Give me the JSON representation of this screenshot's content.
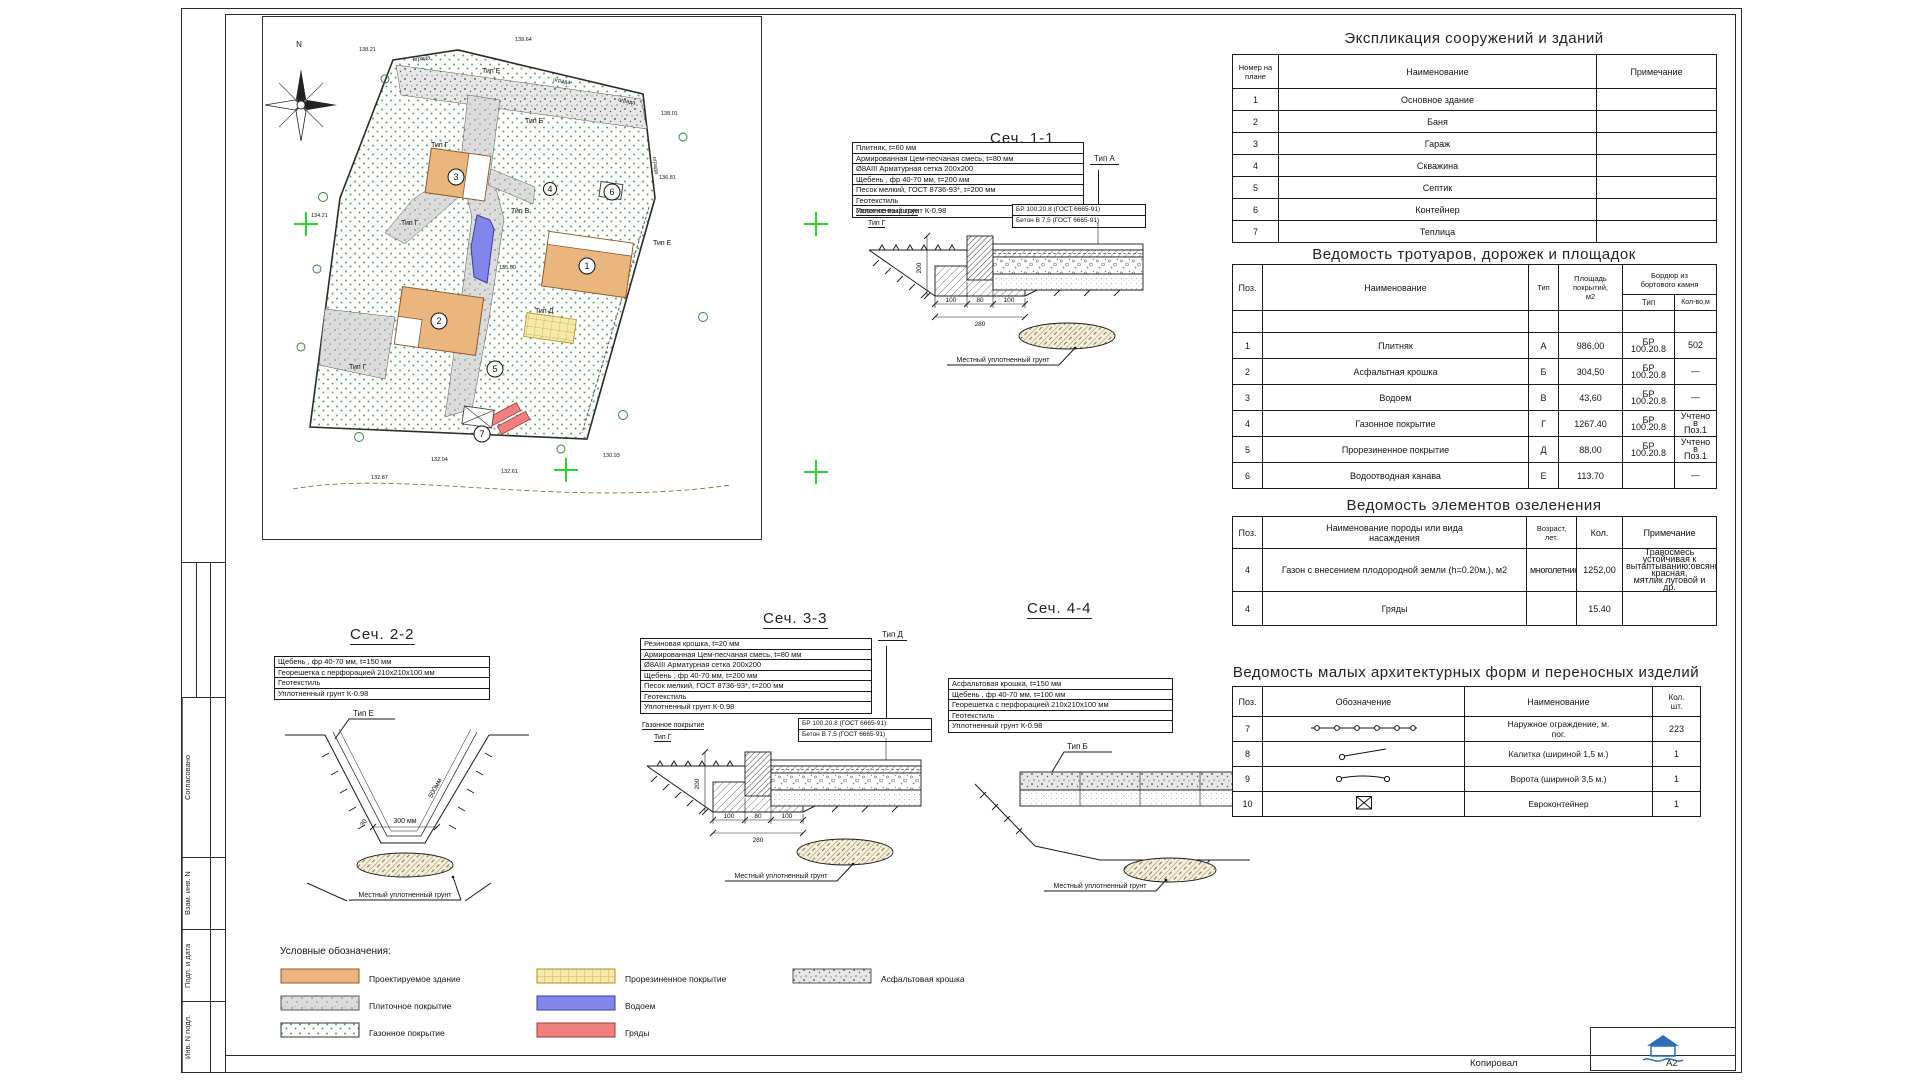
{
  "sheet": {
    "copied": "Копировал",
    "format": "А2",
    "stamps": [
      "Согласовано",
      "Взам. инв. N",
      "Подп. и дата",
      "Инв. N подл."
    ]
  },
  "siteplan": {
    "north": "N",
    "fence_label": "ограда",
    "type_labels": {
      "t1": "Тип Е",
      "t2": "Тип Б",
      "t3": "Тип Г",
      "t4": "Тип В",
      "t5": "Тип Г",
      "t6": "Тип Е",
      "t7": "Тип Д",
      "t8": "Тип Г"
    },
    "numbers": {
      "n1": "1",
      "n2": "2",
      "n3": "3",
      "n4": "4",
      "n5": "5",
      "n6": "6",
      "n7": "7"
    },
    "elevations": {
      "e1": "138.21",
      "e2": "139.64",
      "e3": "138.01",
      "e4": "136.81",
      "e5": "134.21",
      "e6": "132.04",
      "e7": "132.87",
      "e8": "132.61",
      "e9": "130.93",
      "e10": "135.50"
    }
  },
  "sections": {
    "s11": {
      "title": "Сеч. 1-1",
      "flag": "Тип А",
      "layers": [
        "Плитняк, t=60 мм",
        "Армированная Цем-песчаная смесь, t=80 мм",
        "Ø8АIII Арматурная сетка 200х200",
        "Щебень , фр 40-70 мм, t=200 мм",
        "Песок мелкий, ГОСТ 8736-93*, t=200 мм",
        "Геотекстиль",
        "Уплотненный грунт К-0.98"
      ],
      "surface_label": "Газонное покрытие",
      "surface_type": "Тип Г",
      "curb_spec": "БР 100.20.8  (ГОСТ 6665-91)",
      "concrete_spec": "Бетон В 7.5 (ГОСТ 6665-91)",
      "dims": {
        "v": "200",
        "d1": "100",
        "d2": "80",
        "d3": "100",
        "total": "280"
      },
      "ground_label": "Местный уплотненный грунт"
    },
    "s22": {
      "title": "Сеч. 2-2",
      "flag": "Тип Е",
      "layers": [
        "Щебень , фр 40-70 мм, t=150 мм",
        "Георешетка с перфорацией  210х210х100 мм",
        "Геотекстиль",
        "Уплотненный грунт К-0.98"
      ],
      "dims": {
        "w": "300 мм",
        "d": "500мм",
        "angle": "30"
      },
      "ground_label": "Местный уплотненный грунт"
    },
    "s33": {
      "title": "Сеч. 3-3",
      "flag": "Тип Д",
      "layers": [
        "Резиновая крошка, t=20 мм",
        "Армированная Цем-песчаная смесь, t=80 мм",
        "Ø8АIII Арматурная сетка 200х200",
        "Щебень , фр 40-70 мм, t=200 мм",
        "Песок мелкий, ГОСТ 8736-93*, t=200 мм",
        "Геотекстиль",
        "Уплотненный грунт К-0.98"
      ],
      "surface_label": "Газонное покрытие",
      "surface_type": "Тип Г",
      "curb_spec": "БР 100.20.8 (ГОСТ 6665-91)",
      "concrete_spec": "Бетон В 7.5 (ГОСТ 6665-91)",
      "dims": {
        "v": "200",
        "d1": "100",
        "d2": "80",
        "d3": "100",
        "total": "280"
      },
      "ground_label": "Местный уплотненный грунт"
    },
    "s44": {
      "title": "Сеч. 4-4",
      "flag": "Тип Б",
      "layers": [
        "Асфальтовая крошка, t=150 мм",
        "Щебень , фр 40-70 мм, t=100 мм",
        "Георешетка с перфорацией  210х210х100 мм",
        "Геотекстиль",
        "Уплотненный грунт К-0.98"
      ],
      "ground_label": "Местный уплотненный грунт"
    }
  },
  "tables": {
    "expl": {
      "title": "Экспликация сооружений и зданий",
      "col_num": "Номер на\nплане",
      "col_name": "Наименование",
      "col_note": "Примечание",
      "rows": [
        {
          "num": "1",
          "name": "Основное здание",
          "note": ""
        },
        {
          "num": "2",
          "name": "Баня",
          "note": ""
        },
        {
          "num": "3",
          "name": "Гараж",
          "note": ""
        },
        {
          "num": "4",
          "name": "Скважина",
          "note": ""
        },
        {
          "num": "5",
          "name": "Септик",
          "note": ""
        },
        {
          "num": "6",
          "name": "Контейнер",
          "note": ""
        },
        {
          "num": "7",
          "name": "Теплица",
          "note": ""
        }
      ]
    },
    "pavements": {
      "title": "Ведомость тротуаров, дорожек и площадок",
      "col_pos": "Поз.",
      "col_name": "Наименование",
      "col_type": "Тип",
      "col_area": "Площадь\nпокрытий,\nм2",
      "col_curb": "Бордюр из\nбортового камня",
      "col_curb_type": "Тип",
      "col_curb_len": "Кол-во,м",
      "rows": [
        {
          "pos": "1",
          "name": "Плитняк",
          "type": "А",
          "area": "986,00",
          "curb": "БР 100.20.8",
          "len": "502"
        },
        {
          "pos": "2",
          "name": "Асфальтная крошка",
          "type": "Б",
          "area": "304,50",
          "curb": "БР 100.20.8",
          "len": "—"
        },
        {
          "pos": "3",
          "name": "Водоем",
          "type": "В",
          "area": "43,60",
          "curb": "БР 100.20.8",
          "len": "—"
        },
        {
          "pos": "4",
          "name": "Газонное покрытие",
          "type": "Г",
          "area": "1267.40",
          "curb": "БР 100.20.8",
          "len": "Учтено в\nПоз.1"
        },
        {
          "pos": "5",
          "name": "Прорезиненное покрытие",
          "type": "Д",
          "area": "88,00",
          "curb": "БР 100.20.8",
          "len": "Учтено в\nПоз.1"
        },
        {
          "pos": "6",
          "name": "Водоотводная канава",
          "type": "Е",
          "area": "113.70",
          "curb": "",
          "len": "—"
        }
      ]
    },
    "greenery": {
      "title": "Ведомость элементов озеленения",
      "col_pos": "Поз.",
      "col_name": "Наименование породы или вида\nнасаждения",
      "col_age": "Возраст,\nлет.",
      "col_qty": "Кол.",
      "col_note": "Примечание",
      "rows": [
        {
          "pos": "4",
          "name": "Газон с внесением плодородной земли (h=0.20м.), м2",
          "age": "многолетники",
          "qty": "1252,00",
          "note": "Травосмесь устойчивая к\nвытаптыванию:овсяница красная,\nмятлик луговой и др."
        },
        {
          "pos": "4",
          "name": "Гряды",
          "age": "",
          "qty": "15.40",
          "note": ""
        }
      ]
    },
    "maf": {
      "title": "Ведомость малых архитектурных форм и переносных изделий",
      "col_pos": "Поз.",
      "col_sym": "Обозначение",
      "col_name": "Наименование",
      "col_qty": "Кол.\nшт.",
      "rows": [
        {
          "pos": "7",
          "symbol": "fence",
          "name": "Наружное ограждение, м.\nпог.",
          "qty": "223"
        },
        {
          "pos": "8",
          "symbol": "gate",
          "name": "Калитка (шириной 1,5 м.)",
          "qty": "1"
        },
        {
          "pos": "9",
          "symbol": "double-gate",
          "name": "Ворота (шириной 3,5 м.)",
          "qty": "1"
        },
        {
          "pos": "10",
          "symbol": "container",
          "name": "Евроконтейнер",
          "qty": "1"
        }
      ]
    }
  },
  "legend": {
    "title": "Условные обозначения:",
    "items": [
      {
        "key": "building",
        "label": "Проектируемое здание"
      },
      {
        "key": "tile",
        "label": "Плиточное покрытие"
      },
      {
        "key": "lawn",
        "label": "Газонное покрытие"
      },
      {
        "key": "rubber",
        "label": "Прорезиненное покрытие"
      },
      {
        "key": "pond",
        "label": "Водоем"
      },
      {
        "key": "beds",
        "label": "Гряды"
      },
      {
        "key": "asphalt",
        "label": "Асфальтовая крошка"
      }
    ]
  },
  "colors": {
    "building": "#EBB57E",
    "pond": "#8186E8",
    "beds": "#F08080",
    "rubber": "#F6E9AE",
    "lawn_dot": "#57a857",
    "cross": "#2bd42b"
  }
}
